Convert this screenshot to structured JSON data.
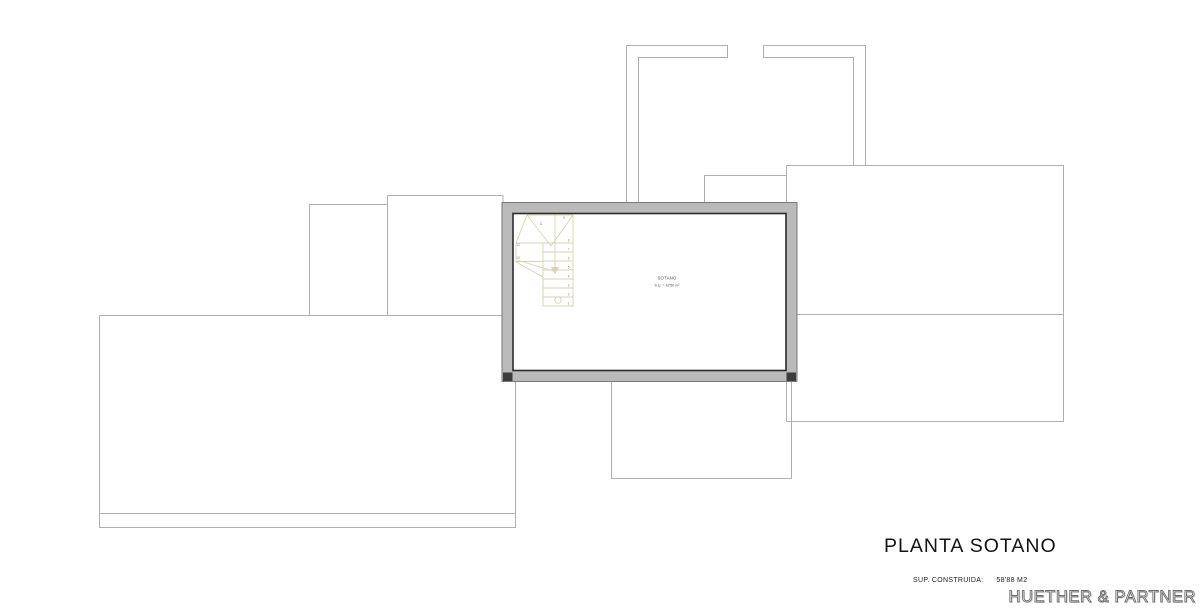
{
  "plan": {
    "title": "PLANTA SOTANO",
    "area_label": "SUP. CONSTRUIDA:",
    "area_value": "58'88 M2",
    "firm": "HUETHER & PARTNER",
    "room": {
      "name": "SOTANO",
      "area": "S.U. = 42'50 m²"
    },
    "stair_numbers": [
      "9",
      "8",
      "7",
      "6",
      "5",
      "4",
      "3",
      "2",
      "1",
      "11",
      "12",
      "13"
    ],
    "colors": {
      "outline_light": "#b0b0b0",
      "wall_fill": "#bababa",
      "wall_inner_stroke": "#2b2b2b",
      "stair_line": "#d8d3b2",
      "title_text": "#141414"
    }
  }
}
